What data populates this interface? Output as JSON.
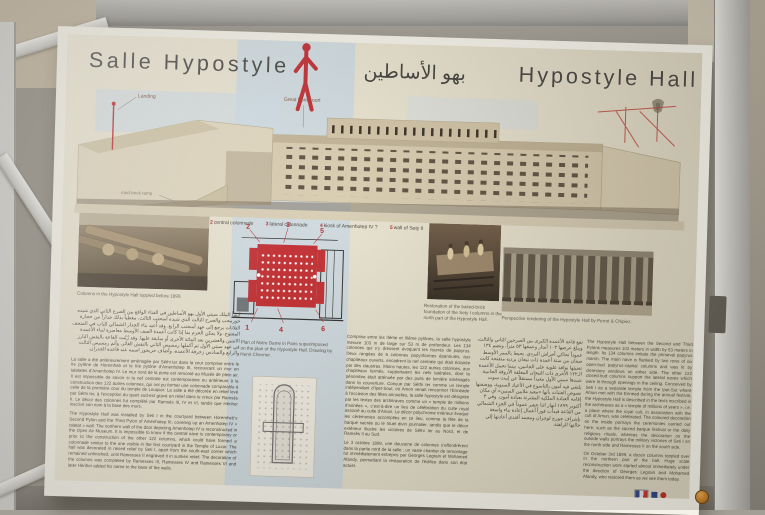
{
  "header": {
    "title_fr": "Salle Hypostyle",
    "title_ar": "بهو الأساطين",
    "title_en": "Hypostyle Hall"
  },
  "colors": {
    "accent_red": "#c0272d",
    "panel_cream": "#e9e3cf",
    "blue_wash": "#cbd9e3",
    "ink": "#403f3d"
  },
  "icons": {
    "scale_figure": "red-human-silhouette",
    "emblem": "egypt-coat-of-arms",
    "logos": "french-flag-and-institution-logos",
    "knob": "orange-frame-knob"
  },
  "axonometric_labels": {
    "landing": "Landing",
    "front_court": "Great front-court",
    "ramp": "mud-brick ramp"
  },
  "legend": {
    "items": [
      {
        "num": "1",
        "label": "2nd pylon"
      },
      {
        "num": "2",
        "label": "central colonnade"
      },
      {
        "num": "3",
        "label": "lateral colonnade"
      },
      {
        "num": "4",
        "label": "kiosk of Amenhotep IV ?"
      },
      {
        "num": "5",
        "label": "wall of Sety II"
      },
      {
        "num": "6",
        "label": "3rd pylon"
      }
    ]
  },
  "captions": {
    "photo_left": "Columns in the Hypostyle Hall toppled before 1899.",
    "notre_dame_plan": "Plan of Notre Dame in Paris superimposed on the plan of the Hypostyle Hall. Drawing by Henri Chevrier.",
    "excavation": "Restoration of the baked-brick foundation of the Sety I columns in the north part of the Hypostyle Hall.",
    "engraving": "Perspective rendering of the Hypostyle Hall by Perrot & Chipiez."
  },
  "texts": {
    "left_arabic": "أنشأ الملك سيتي الأول بهو الأساطين في الفناء الواقع بين الصرح الثاني الذي شيده حورمحب والصرح الثالث الذي شيده أمنحتب الثالث، مغطياً بذلك جداراً من حجارة التلاتات يرجع إلى عهد أمنحتب الرابع. وقد أُعيد بناء الجدار الشمالي للباب في المتحف المفتوح. ولا يمكن الجزم بما إذا كانت أعمدة الصف الأوسط معاصرة لبناء الأعمدة الاثنتين والعشرين بعد المائة الأخرى أو سابقة عليها. وقد زُيّنت القاعة بالنقش البارز في عهد سيتي الأول ثم أكملها رمسيس الثاني بالنقش الغائر، وأتم رمسيس الثالث والرابع والسادس زخرفة الأعمدة، وأضاف حريحور اسمه عند قاعدة الجدران.",
    "left_french": "La salle a été antérieurement aménagée par Séthi Ier dans la cour comprise entre le IIe pylône de Horemheb et le IIIe pylône d’Amenhotep III, recouvrant un mur en talatates d’Amenhotep IV. Le mur nord de la porte est remonté au Musée de plein air. Il est impossible de savoir si la nef centrale est contemporaine ou antérieure à la construction des 122 autres colonnes, qui ont pu former une colonnade comparable à celle de la première cour du temple de Louqsor. La salle a été décorée en relief levé par Séthi Ier, à l’exception du quart sud-est gravé en relief dans le creux par Ramsès II. Le décor des colonnes fut complété par Ramsès III, IV et VI, tandis que Hérihor inscrivit son nom à la base des murs.",
    "left_english": "The Hypostyle Hall was installed by Seti I in the courtyard between Horemheb’s Second Pylon and the Third Pylon of Amenhotep III, covering up an Amenhotep IV « talatat » wall. The northern wall of the door depicting Amenhotep IV is reconstructed in the Open Air Museum. It is impossible to know if the central nave is contemporary or prior to the construction of the other 122 columns, which could have formed a colonnade similar to the one visible in the first courtyard in the Temple of Luxor. The hall was decorated in raised relief by Seti I, apart from the south-east corner which remained unfinished, until Ramesses II engraved it in sunken relief. The decoration of the columns was completed by Ramesses III, Ramesses IV and Ramesses VI and later Herihor added his name to the base of the walls.",
    "mid_french_p1": "Comprise entre les IIème et IIIème pylônes, la salle hypostyle mesure 103 m de large sur 53 m de profondeur. Les 134 colonnes qui s’y dressent évoquent les fourrés de papyrus. Deux rangées de 6 colonnes papyriformes épanouies, aux chapiteaux ouverts, encadrent la nef centrale qui était éclairée par des claustras. Moins hautes, les 122 autres colonnes, aux chapiteaux fermés, supportaient les nefs latérales, dont la pénombre était atténuée par des puits de lumière aménagés dans la couverture. Conçue par Séthi Ier comme un temple indépendant d’Ipet-Sout, où Amon venait rencontrer l’Ennéade à l’occasion des fêtes annuelles, la salle hypostyle est désignée par les textes des architraves comme un « temple de millions d’années », c’est-à-dire un lieu de célébration du culte royal associé au culte d’Amon. Le décor polychrome intérieur évoque les cérémonies accomplies en ce lieu, comme la fête de la barque sacrée ou le rituel divin journalier, tandis que le décor extérieur illustre les victoires de Séthi Ier au Nord, et de Ramsès II au Sud.",
    "mid_french_p2": "Le 3 octobre 1899, une douzaine de colonnes s’effondrèrent dans la partie nord de la salle ; un vaste chantier de remontage fut immédiatement entrepris par Georges Legrain et Mohamed Afandy, permettant la restauration de l’édifice dans son état actuel.",
    "mid_arabic": "تقع قاعة الأعمدة الكبرى بين الصرحين الثاني والثالث، ويبلغ عرضها ١٠٣ أمتار وعمقها ٥٣ متراً، وتضم ١٣٤ عموداً تحاكي أحراش البردي. يحيط بالممر الأوسط صفان من ستة أعمدة ذات تيجان بردية متفتحة كانت تضيئها نوافذ علوية على الجانبين، بينما تحمل الأعمدة الـ١٢٢ الأخرى ذات التيجان المغلقة الأروقة الجانبية. شيدها سيتي الأول معبداً مستقلاً عن إيبت سوت يلتقي فيه آمون بالتاسوع في الأعياد السنوية، ووصفتها نصوص العتبات بأنها «معبد ملايين السنين» أي مكان إقامة العبادة الملكية المقترنة بعبادة آمون. وفي ٣ أكتوبر ١٨٩٩ انهار اثنا عشر عموداً في الجزء الشمالي من القاعة فبدأت فوراً أعمال إعادة بناء واسعة بإشراف جورج لوجران ومحمد أفندي أعادتها إلى حالتها الراهنة.",
    "right_english_p1": "The Hypostyle Hall between the Second and Third Pylons measures 103 meters in width by 53 meters in length. Its 134 columns imitate the primeval papyrus marsh. The main nave is flanked by two rows of six open-bud papyrus-capital columns and was lit by clerestory windows on either side. The other 122 closed-bud columns support the lateral naves which were lit through openings in the ceiling. Conceived by Seti I as a separate temple from the Ipet-Sut where Amun met with the Ennead during the annual festival, the Hypostyle Hall is described in the texts inscribed in the architraves as a « temple of millions of years », i.e. a place where the royal cult, in association with the cult of Amun, was celebrated. The coloured decoration on the inside portrays the ceremonies carried out here, such as the sacred barque festival or the daily religious rituals, whereas the decoration on the outside walls portrays the military victories of Seti I on the north side and Ramesses II on the south side.",
    "right_english_p2": "On October 3rd 1899, a dozen columns toppled over in the northern part of the hall. Huge scale reconstruction work started almost immediately under the direction of Georges Legrain and Mohamed Afandy, who restored them as we see them today."
  }
}
